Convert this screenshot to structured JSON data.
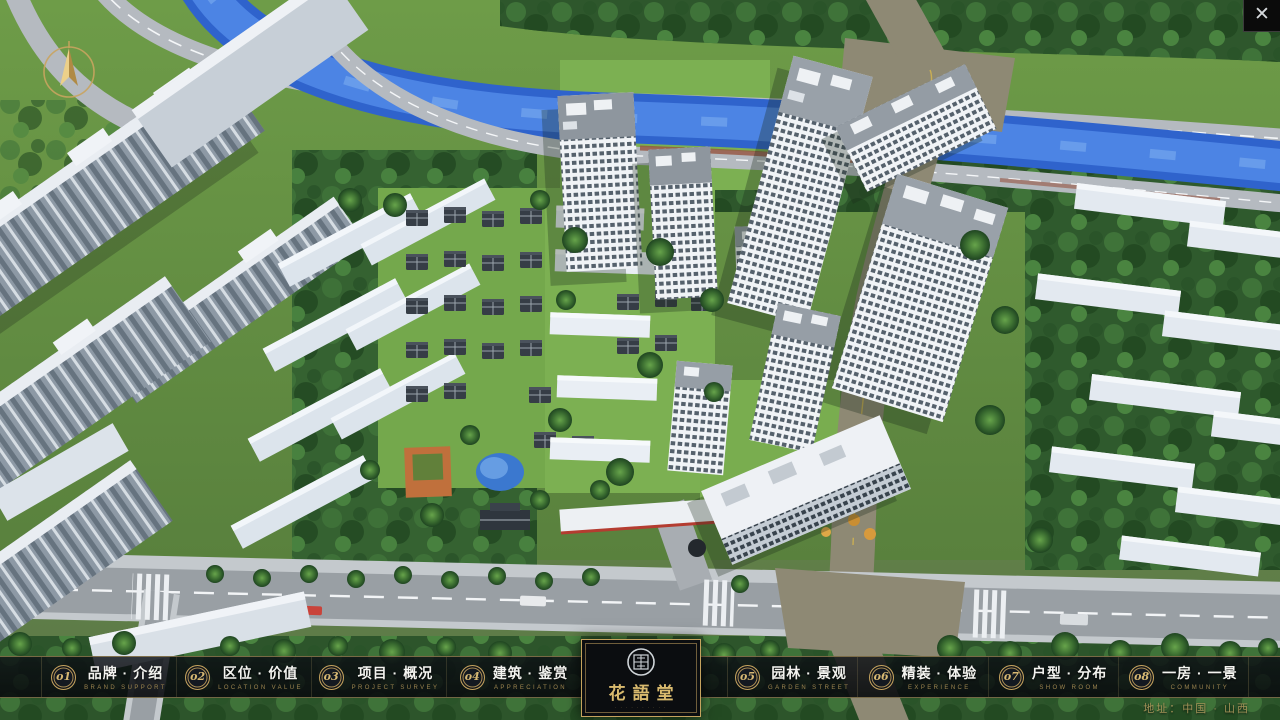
{
  "window": {
    "close_glyph": "✕"
  },
  "nav": {
    "items": [
      {
        "num": "o1",
        "label": "品牌 · 介绍",
        "caption": "BRAND SUPPORT"
      },
      {
        "num": "o2",
        "label": "区位 · 价值",
        "caption": "LOCATION VALUE"
      },
      {
        "num": "o3",
        "label": "项目 · 概况",
        "caption": "PROJECT SURVEY"
      },
      {
        "num": "o4",
        "label": "建筑 · 鉴赏",
        "caption": "APPRECIATION"
      },
      {
        "num": "o5",
        "label": "园林 · 景观",
        "caption": "GARDEN STREET"
      },
      {
        "num": "o6",
        "label": "精装 · 体验",
        "caption": "EXPERIENCE"
      },
      {
        "num": "o7",
        "label": "户型 · 分布",
        "caption": "SHOW ROOM"
      },
      {
        "num": "o8",
        "label": "一房 · 一景",
        "caption": "COMMUNITY"
      }
    ],
    "logo": {
      "title": "花語堂",
      "tagline": "· · · · · · · · · ·"
    },
    "address": "地址：中国 · 山西"
  },
  "colors": {
    "accent_gold": "#c5a35e",
    "bar_background": "#0b0d11",
    "river_blue": "#2f63cc",
    "grass_green": "#6e9c48",
    "road_gray": "#9aa0a5",
    "tan_road": "#8e8974"
  }
}
